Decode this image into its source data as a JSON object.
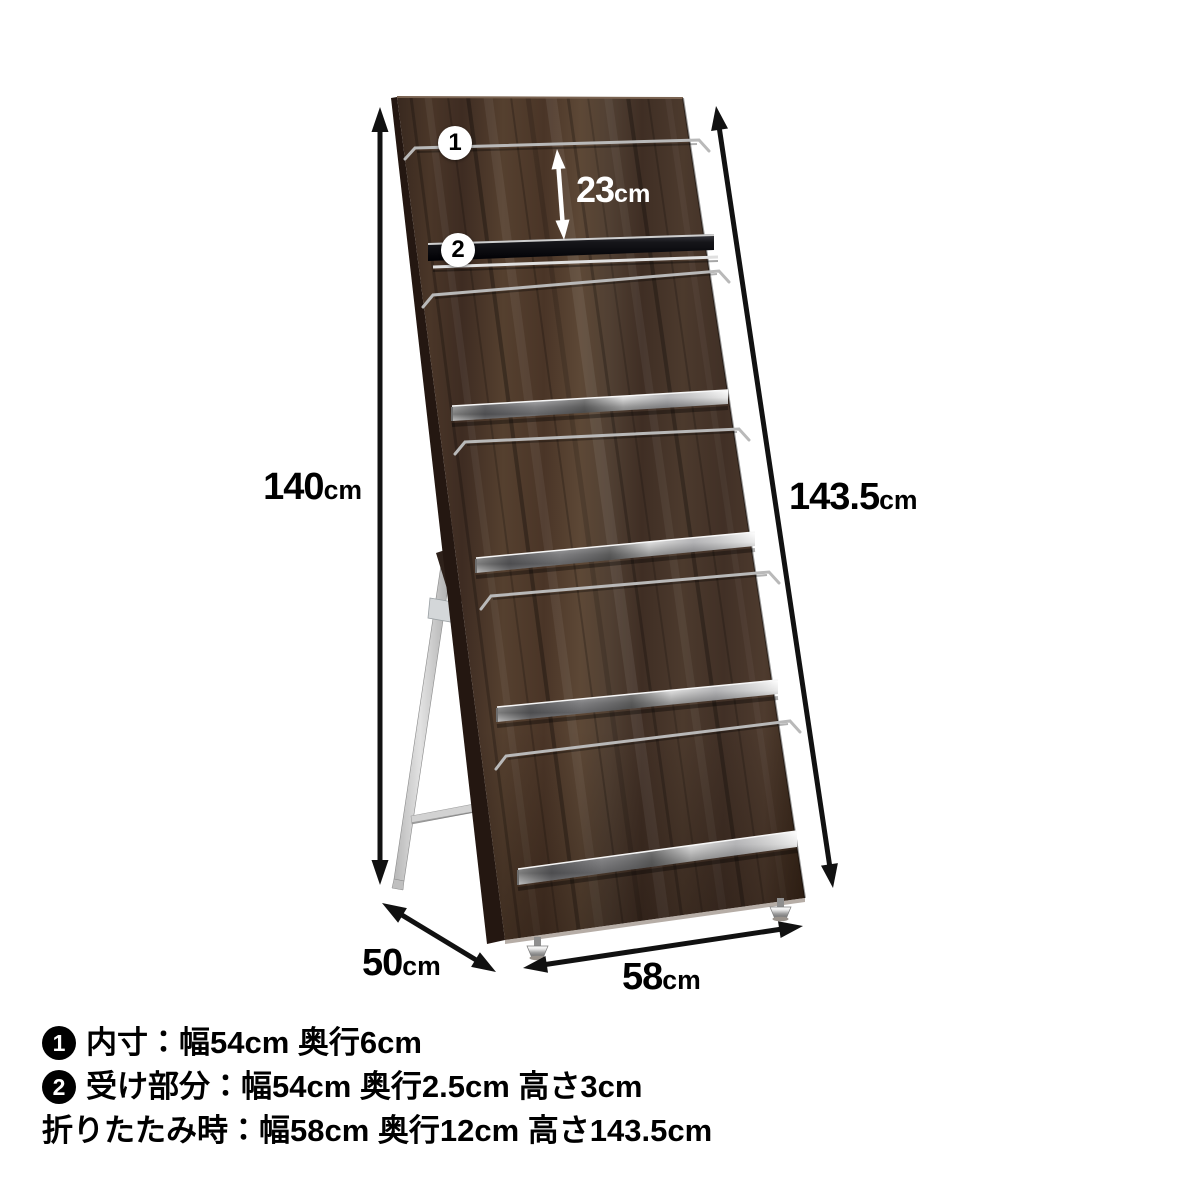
{
  "colors": {
    "background": "#ffffff",
    "text": "#000000",
    "arrow": "#111111",
    "inner_arrow": "#ffffff",
    "wood": "#4a3527",
    "wood_edge": "#241711",
    "chrome": "#c9c9c9",
    "callout_bg": "#ffffff",
    "callout_text": "#000000",
    "badge_bg": "#000000",
    "badge_text": "#ffffff"
  },
  "dimensions": {
    "height_left": {
      "value": "140",
      "unit": "cm"
    },
    "height_right": {
      "value": "143.5",
      "unit": "cm"
    },
    "rail_gap": {
      "value": "23",
      "unit": "cm"
    },
    "depth": {
      "value": "50",
      "unit": "cm"
    },
    "width": {
      "value": "58",
      "unit": "cm"
    }
  },
  "callouts": [
    {
      "id": "1"
    },
    {
      "id": "2"
    }
  ],
  "legend": {
    "items": [
      {
        "badge": "1",
        "text": "内寸：幅54cm 奥行6cm"
      },
      {
        "badge": "2",
        "text": "受け部分：幅54cm 奥行2.5cm 高さ3cm"
      },
      {
        "badge": null,
        "text": "折りたたみ時：幅58cm 奥行12cm 高さ143.5cm"
      }
    ]
  }
}
